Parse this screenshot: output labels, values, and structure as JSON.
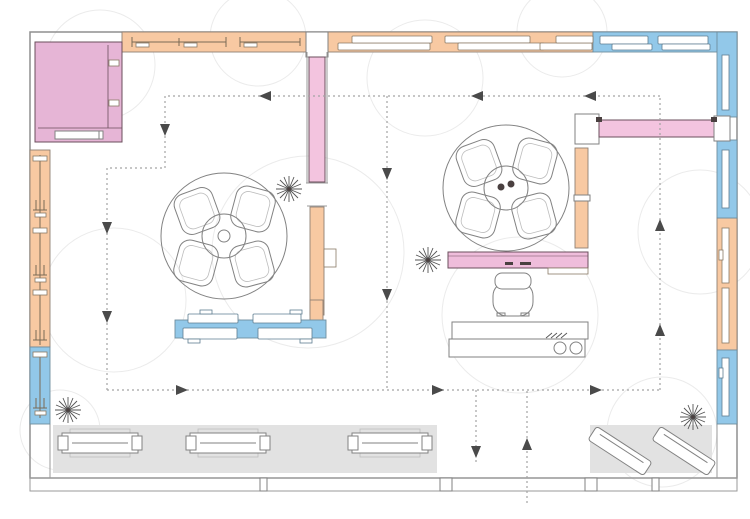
{
  "meta": {
    "title": "Retail shop floor plan with furniture and circulation path",
    "drawing_type": "architectural plan",
    "canvas": {
      "width": 750,
      "height": 519
    }
  },
  "colors": {
    "shelving_orange": "#f8c9a2",
    "shelving_blue": "#92c8e9",
    "partition_pink": "#f3c4df",
    "block_pink": "#e6b5d6",
    "counter_pink": "#efbddb",
    "platform_gray": "#e2e2e2",
    "arrow": "#4a4a4a",
    "white": "#ffffff"
  },
  "inventory": {
    "wall_shelving_segments_orange": 5,
    "wall_shelving_segments_blue": 6,
    "pink_partitions": 2,
    "pink_blocks": 1,
    "pink_counters": 1,
    "round_table_groups": 2,
    "chairs_per_table": 4,
    "cash_desk": 1,
    "armchair": 1,
    "window_display_platforms": 2,
    "display_benches_horizontal": 3,
    "display_benches_diagonal": 2,
    "plants": 4,
    "circulation_arrows": 15,
    "entrances": 1
  }
}
